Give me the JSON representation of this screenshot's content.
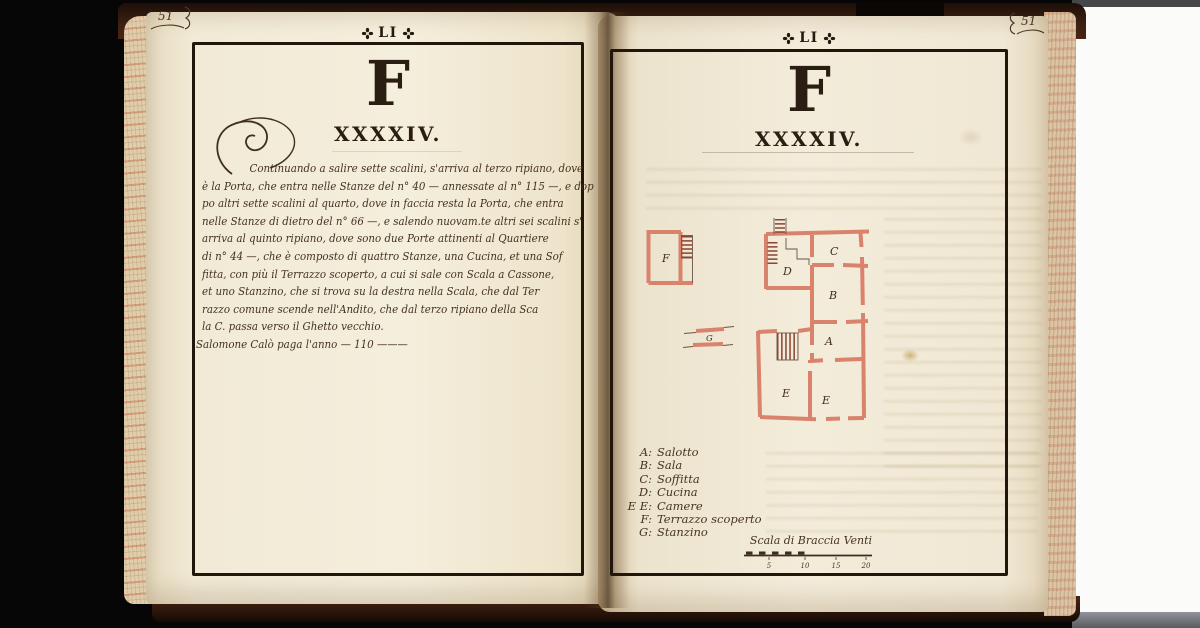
{
  "colors": {
    "page_cream": "#f2ebd7",
    "ink_black": "#241a10",
    "handwriting_brown": "#46331f",
    "plan_wall_salmon": "#d9826c",
    "plan_hatch_red": "#8a4434",
    "edge_marble_red": "#c46a50",
    "cover_brown": "#3a1f11"
  },
  "left_page": {
    "folio_number": "51",
    "header_text": "LI",
    "chapter_letter": "F",
    "chapter_numeral": "XXXXIV.",
    "body_lines": [
      "Continuando a salire sette scalini, s'arriva al terzo ripiano, dove",
      "è la Porta, che entra nelle Stanze del n° 40 — annessate al n° 115 —, e dop",
      "po altri sette scalini al quarto, dove in faccia resta la Porta, che entra",
      "nelle Stanze di dietro del n° 66 —, e salendo nuovam.te altri sei scalini s'",
      "arriva al quinto ripiano, dove sono due Porte attinenti al Quartiere",
      "di n° 44 —, che è composto di quattro Stanze, una Cucina, et una Sof",
      "fitta, con più il Terrazzo scoperto, a cui si sale con Scala a Cassone,",
      "et uno Stanzino, che si trova su la destra nella Scala, che dal Ter",
      "razzo comune scende nell'Andito, che dal terzo ripiano della Sca",
      "la C. passa verso il Ghetto vecchio.",
      "Salomone Calò paga l'anno — 110 ———"
    ]
  },
  "right_page": {
    "folio_number": "51",
    "header_text": "LI",
    "chapter_letter": "F",
    "chapter_numeral": "XXXXIV.",
    "plan": {
      "room_labels": [
        "F",
        "G",
        "D",
        "C",
        "B",
        "A",
        "E",
        "E"
      ]
    },
    "legend": [
      {
        "key": "A:",
        "name": "Salotto"
      },
      {
        "key": "B:",
        "name": "Sala"
      },
      {
        "key": "C:",
        "name": "Soffitta"
      },
      {
        "key": "D:",
        "name": "Cucina"
      },
      {
        "key": "E E:",
        "name": "Camere"
      },
      {
        "key": "F:",
        "name": "Terrazzo scoperto"
      },
      {
        "key": "G:",
        "name": "Stanzino"
      }
    ],
    "scale_bar": {
      "caption": "Scala di Braccia Venti",
      "ticks": [
        "5",
        "10",
        "15",
        "20"
      ]
    }
  }
}
